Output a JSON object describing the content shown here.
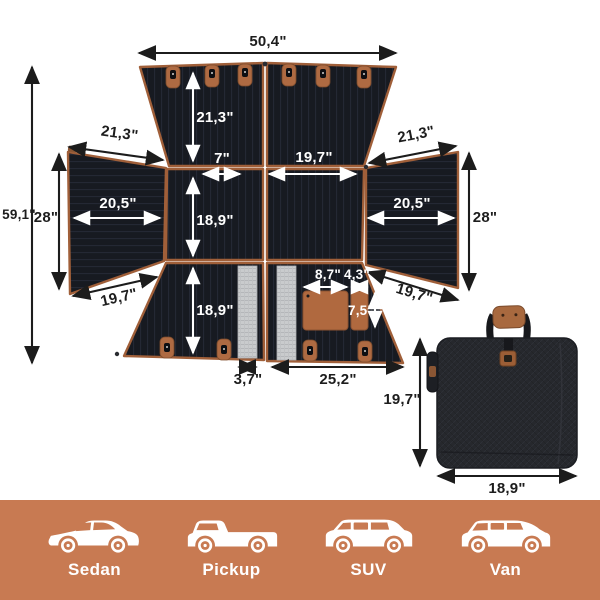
{
  "diagram": {
    "title": "unfolded-car-seat-cover-dimension-diagram",
    "dimensions": {
      "top_width": "50,4\"",
      "overall_height": "59,1\"",
      "backrest_height": "21,3\"",
      "left_flap_top_edge": "21,3\"",
      "right_flap_top_edge": "21,3\"",
      "center_gap_width": "7\"",
      "seat_panel_width": "19,7\"",
      "left_flap_width": "20,5\"",
      "right_flap_width": "20,5\"",
      "left_flap_height": "28\"",
      "right_flap_height": "28\"",
      "seat_panel_height": "18,9\"",
      "left_flap_bottom_edge": "19,7\"",
      "right_flap_bottom_edge": "19,7\"",
      "bottom_panel_height": "18,9\"",
      "pocket_large_width": "8,7\"",
      "pocket_small_width": "4,3\"",
      "pocket_height": "7,5\"",
      "mesh_strip_width": "3,7\"",
      "bottom_panel_width": "25,2\"",
      "bag_height": "19,7\"",
      "bag_width": "18,9\""
    }
  },
  "footer": {
    "background_color": "#C87A52",
    "vehicles": [
      {
        "icon": "sedan-icon",
        "label": "Sedan"
      },
      {
        "icon": "pickup-icon",
        "label": "Pickup"
      },
      {
        "icon": "suv-icon",
        "label": "SUV"
      },
      {
        "icon": "van-icon",
        "label": "Van"
      }
    ]
  },
  "colors": {
    "mat_fabric": "#171A21",
    "leather_trim": "#A05F39",
    "pocket": "#B0693F",
    "mesh": "#C9CBCD",
    "bag_fabric": "#26282D",
    "arrow_dark": "#1C1C1C",
    "arrow_light": "#FFFFFF"
  }
}
